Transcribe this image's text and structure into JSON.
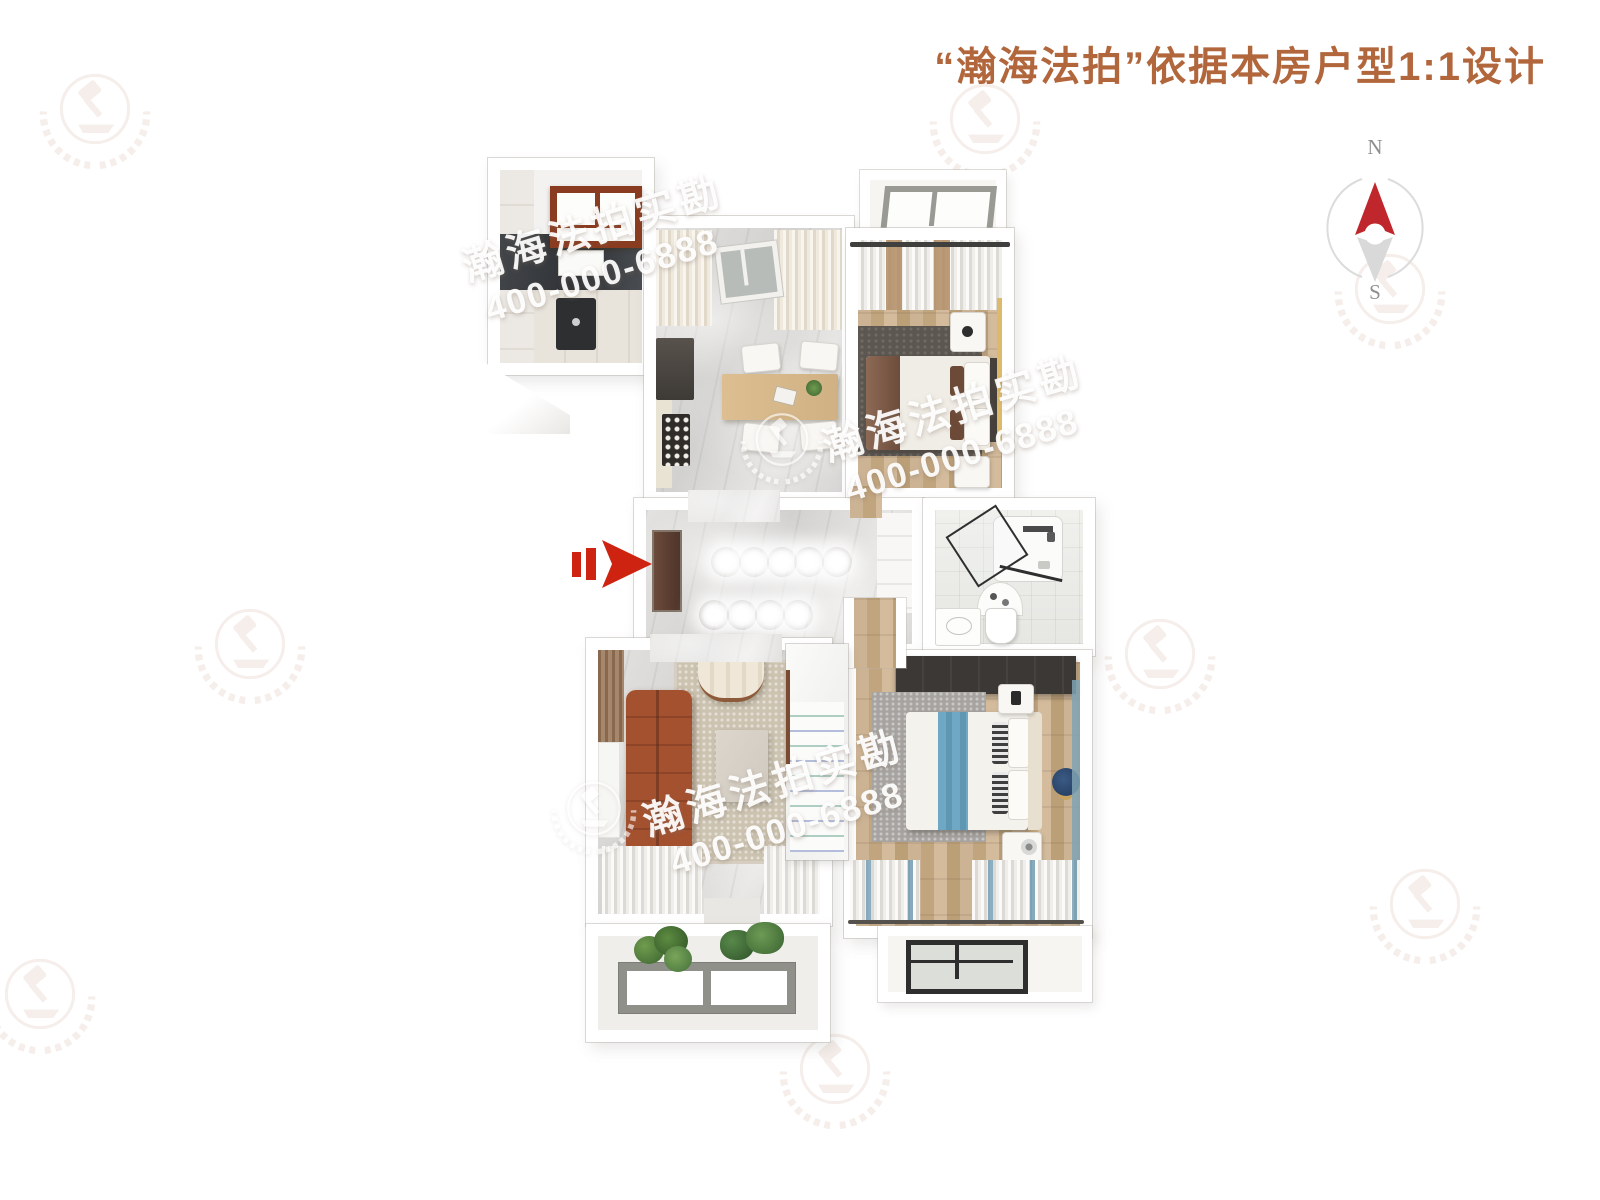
{
  "header": {
    "title": "“瀚海法拍”依据本房户型1:1设计",
    "title_color": "#b2663c"
  },
  "compass": {
    "north": "N",
    "south": "S",
    "needle_color": "#c0272c",
    "ring_color": "#dcdcdc"
  },
  "watermark": {
    "brand": "瀚海法拍实勘",
    "phone": "400-000-6888",
    "logo_icon": "gavel-wreath-logo"
  },
  "colors": {
    "entry_arrow": "#ce2310",
    "kitchen_window_frame": "#8a3c20",
    "sofa": "#9a4a2d",
    "north_bed_accent": "#7b5845",
    "south_bed_accent": "#6fa8c4",
    "wardrobe": "#3b3835"
  }
}
